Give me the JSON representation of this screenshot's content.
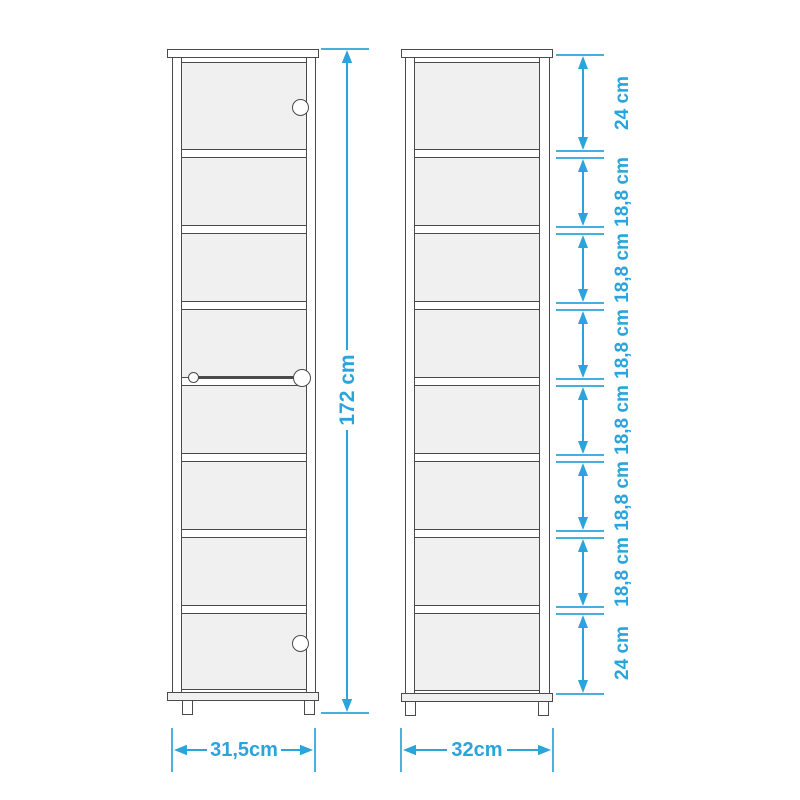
{
  "diagram": {
    "colors": {
      "accent": "#2BA3DB",
      "outline": "#4A4A4A",
      "panel_fill": "#F0F0F0"
    },
    "front_view": {
      "height_label": "172 cm",
      "width_label": "31,5cm"
    },
    "side_view": {
      "width_label": "32cm",
      "shelf_segments": [
        "24 cm",
        "18,8 cm",
        "18,8 cm",
        "18,8 cm",
        "18,8 cm",
        "18,8 cm",
        "18,8 cm",
        "24 cm"
      ]
    }
  }
}
